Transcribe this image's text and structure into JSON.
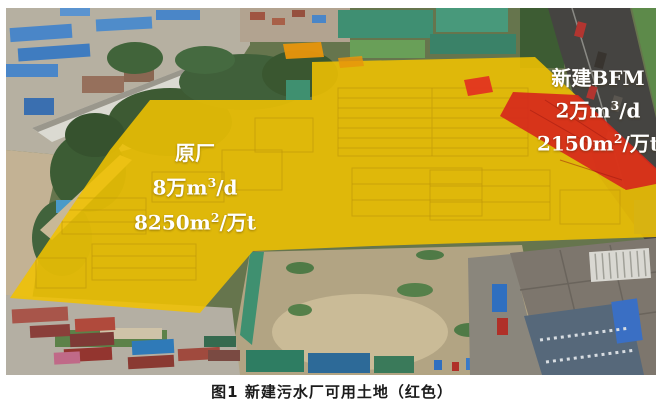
{
  "figure": {
    "caption": "图1 新建污水厂可用土地（红色）",
    "overlay_colors": {
      "existing_plant_fill": "#F0C101",
      "new_bfm_fill": "#D6281C"
    },
    "labels": {
      "original_plant": {
        "title": "原厂",
        "capacity": {
          "pre": "8万m",
          "sup": "3",
          "post": "/d"
        },
        "footprint": {
          "pre": "8250m",
          "sup": "2",
          "post": "/万t"
        }
      },
      "new_bfm": {
        "title": "新建BFM",
        "capacity": {
          "pre": "2万m",
          "sup": "3",
          "post": "/d"
        },
        "footprint": {
          "pre": "2150m",
          "sup": "2",
          "post": "/万t"
        }
      }
    }
  }
}
